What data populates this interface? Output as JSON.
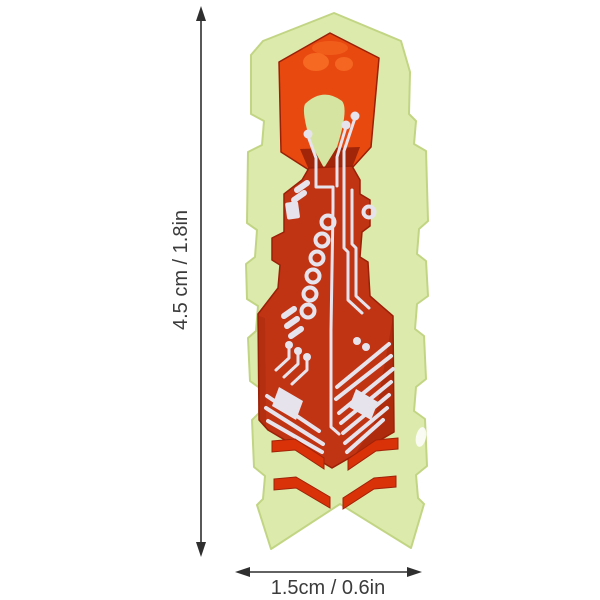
{
  "annotations": {
    "height_label": "4.5 cm / 1.8in",
    "width_label": "1.5cm / 0.6in"
  },
  "colors": {
    "annotation_text": "#3b3b3b",
    "arrow": "#2f2f2f",
    "background": "#ffffff",
    "body_green": "#dcebac",
    "body_green_edge": "#c2d584",
    "window_green": "#d5e4a0",
    "shell_red_bright": "#e8490f",
    "shell_red_mid": "#c03413",
    "shell_red_dark": "#8f1d06",
    "chevron_red": "#d93108",
    "trace_white": "#e7e3ec",
    "highlight_white": "#ffffff"
  }
}
